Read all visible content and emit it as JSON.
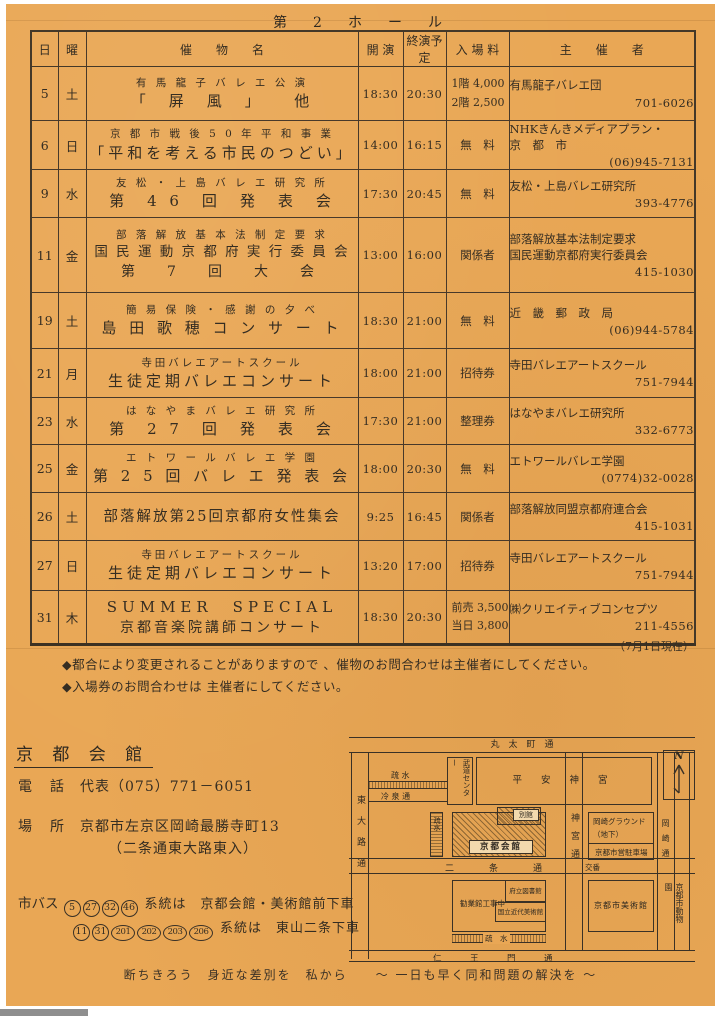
{
  "title": "第　2　ホ　ー　ル",
  "table": {
    "headers": {
      "day": "日",
      "weekday": "曜",
      "event": "催　　物　　名",
      "start": "開 演",
      "end": "終演予定",
      "admission": "入 場 料",
      "organizer": "主　　催　　者"
    },
    "rows": [
      {
        "day": "5",
        "wd": "土",
        "ev1": "有 馬 龍 子 バ レ エ 公 演",
        "ev2": "「　屏　風　」　　他",
        "start": "18:30",
        "end": "20:30",
        "adm1": "1階 4,000",
        "adm2": "2階 2,500",
        "org1": "有馬龍子バレエ団",
        "phone": "701-6026"
      },
      {
        "day": "6",
        "wd": "日",
        "ev1": "京 都 市 戦 後 5 0 年 平 和 事 業",
        "ev2": "「平和を考える市民のつどい」",
        "start": "14:00",
        "end": "16:15",
        "adm1": "無　料",
        "org1": "NHKきんきメディアプラン・",
        "org2": "京　都　市",
        "phone": "(06)945-7131"
      },
      {
        "day": "9",
        "wd": "水",
        "ev1": "友 松 ・ 上 島 バ レ エ 研 究 所",
        "ev2": "第　4 6　回　発　表　会",
        "start": "17:30",
        "end": "20:45",
        "adm1": "無　料",
        "org1": "友松・上島バレエ研究所",
        "phone": "393-4776"
      },
      {
        "day": "11",
        "wd": "金",
        "ev1": "部 落 解 放 基 本 法 制 定 要 求",
        "ev2": "国 民 運 動 京 都 府 実 行 委 員 会",
        "ev3": "第　7　回　大　会",
        "start": "13:00",
        "end": "16:00",
        "adm1": "関係者",
        "org1": "部落解放基本法制定要求",
        "org2": "国民運動京都府実行委員会",
        "phone": "415-1030"
      },
      {
        "day": "19",
        "wd": "土",
        "ev1": "簡 易 保 険 ・ 感 謝 の 夕 べ",
        "ev2": "島 田 歌 穂 コ ン サ ー ト",
        "start": "18:30",
        "end": "21:00",
        "adm1": "無　料",
        "org1": "近　畿　郵　政　局",
        "phone": "(06)944-5784"
      },
      {
        "day": "21",
        "wd": "月",
        "ev1": "寺田バレエアートスクール",
        "ev2": "生徒定期バレエコンサート",
        "start": "18:00",
        "end": "21:00",
        "adm1": "招待券",
        "org1": "寺田バレエアートスクール",
        "phone": "751-7944"
      },
      {
        "day": "23",
        "wd": "水",
        "ev1": "は な や ま バ レ エ 研 究 所",
        "ev2": "第　2 7　回　発　表　会",
        "start": "17:30",
        "end": "21:00",
        "adm1": "整理券",
        "org1": "はなやまバレエ研究所",
        "phone": "332-6773"
      },
      {
        "day": "25",
        "wd": "金",
        "ev1": "エ ト ワ ー ル バ レ エ 学 園",
        "ev2": "第 2 5 回 バ レ エ 発 表 会",
        "start": "18:00",
        "end": "20:30",
        "adm1": "無　料",
        "org1": "エトワールバレエ学園",
        "phone": "(0774)32-0028"
      },
      {
        "day": "26",
        "wd": "土",
        "ev2": "部落解放第25回京都府女性集会",
        "start": "9:25",
        "end": "16:45",
        "adm1": "関係者",
        "org1": "部落解放同盟京都府連合会",
        "phone": "415-1031"
      },
      {
        "day": "27",
        "wd": "日",
        "ev1": "寺田バレエアートスクール",
        "ev2": "生徒定期バレエコンサート",
        "start": "13:20",
        "end": "17:00",
        "adm1": "招待券",
        "org1": "寺田バレエアートスクール",
        "phone": "751-7944"
      },
      {
        "day": "31",
        "wd": "木",
        "ev1": "SUMMER　SPECIAL",
        "ev2": "京都音楽院講師コンサート",
        "start": "18:30",
        "end": "20:30",
        "adm1": "前売 3,500",
        "adm2": "当日 3,800",
        "org1": "㈱クリエイティブコンセプツ",
        "phone": "211-4556"
      }
    ]
  },
  "as_of": "（7月1日現在）",
  "notes": [
    "◆都合により変更されることがありますので 、催物のお問合わせは主催者にしてください。",
    "◆入場券のお問合わせは 主催者にしてください。"
  ],
  "venue": {
    "name": "京 都 会 館",
    "phone_label": "電　話",
    "phone_value": "代表（075）771－6051",
    "place_label": "場　所",
    "place_value": "京都市左京区岡崎最勝寺町13",
    "place_value2": "（二条通東大路東入）",
    "bus_label": "市バス",
    "bus1_routes": [
      "5",
      "27",
      "32",
      "46"
    ],
    "bus1_text": "系統は　京都会館・美術館前下車",
    "bus2_routes": [
      "11",
      "31",
      "201",
      "202",
      "203",
      "206"
    ],
    "bus2_text": "系統は　東山二条下車"
  },
  "map": {
    "marutamachi": "丸　太　町　通",
    "budo_center": "武道センター",
    "heian_jingu": "平 安 神 宮",
    "compass_n": "N",
    "sosui_top": "疏 水",
    "reisen": "冷 泉 通",
    "higashioji": "東大路通",
    "sosui_left": "疏水",
    "kyoto_kaikan": "京都会館",
    "bekkan": "別館",
    "jingu_dori": "神宮通",
    "okazaki_ground": "岡崎グラウンド",
    "chika": "（地下）",
    "parking": "京都市営駐車場",
    "okazaki_dori": "岡崎通",
    "nijo": "二　条　通",
    "koban": "交番",
    "kangyokan": "勧業館工事中",
    "library": "府立図書館",
    "modern_museum": "国立近代美術館",
    "sosui_bottom": "疏　水",
    "city_museum": "京都市美術館",
    "zoo": "京都市動物園",
    "niomon": "仁　王　門　通"
  },
  "slogan": "断ちきろう　身近な差別を　私から　　～ 一日も早く同和問題の解決を ～"
}
